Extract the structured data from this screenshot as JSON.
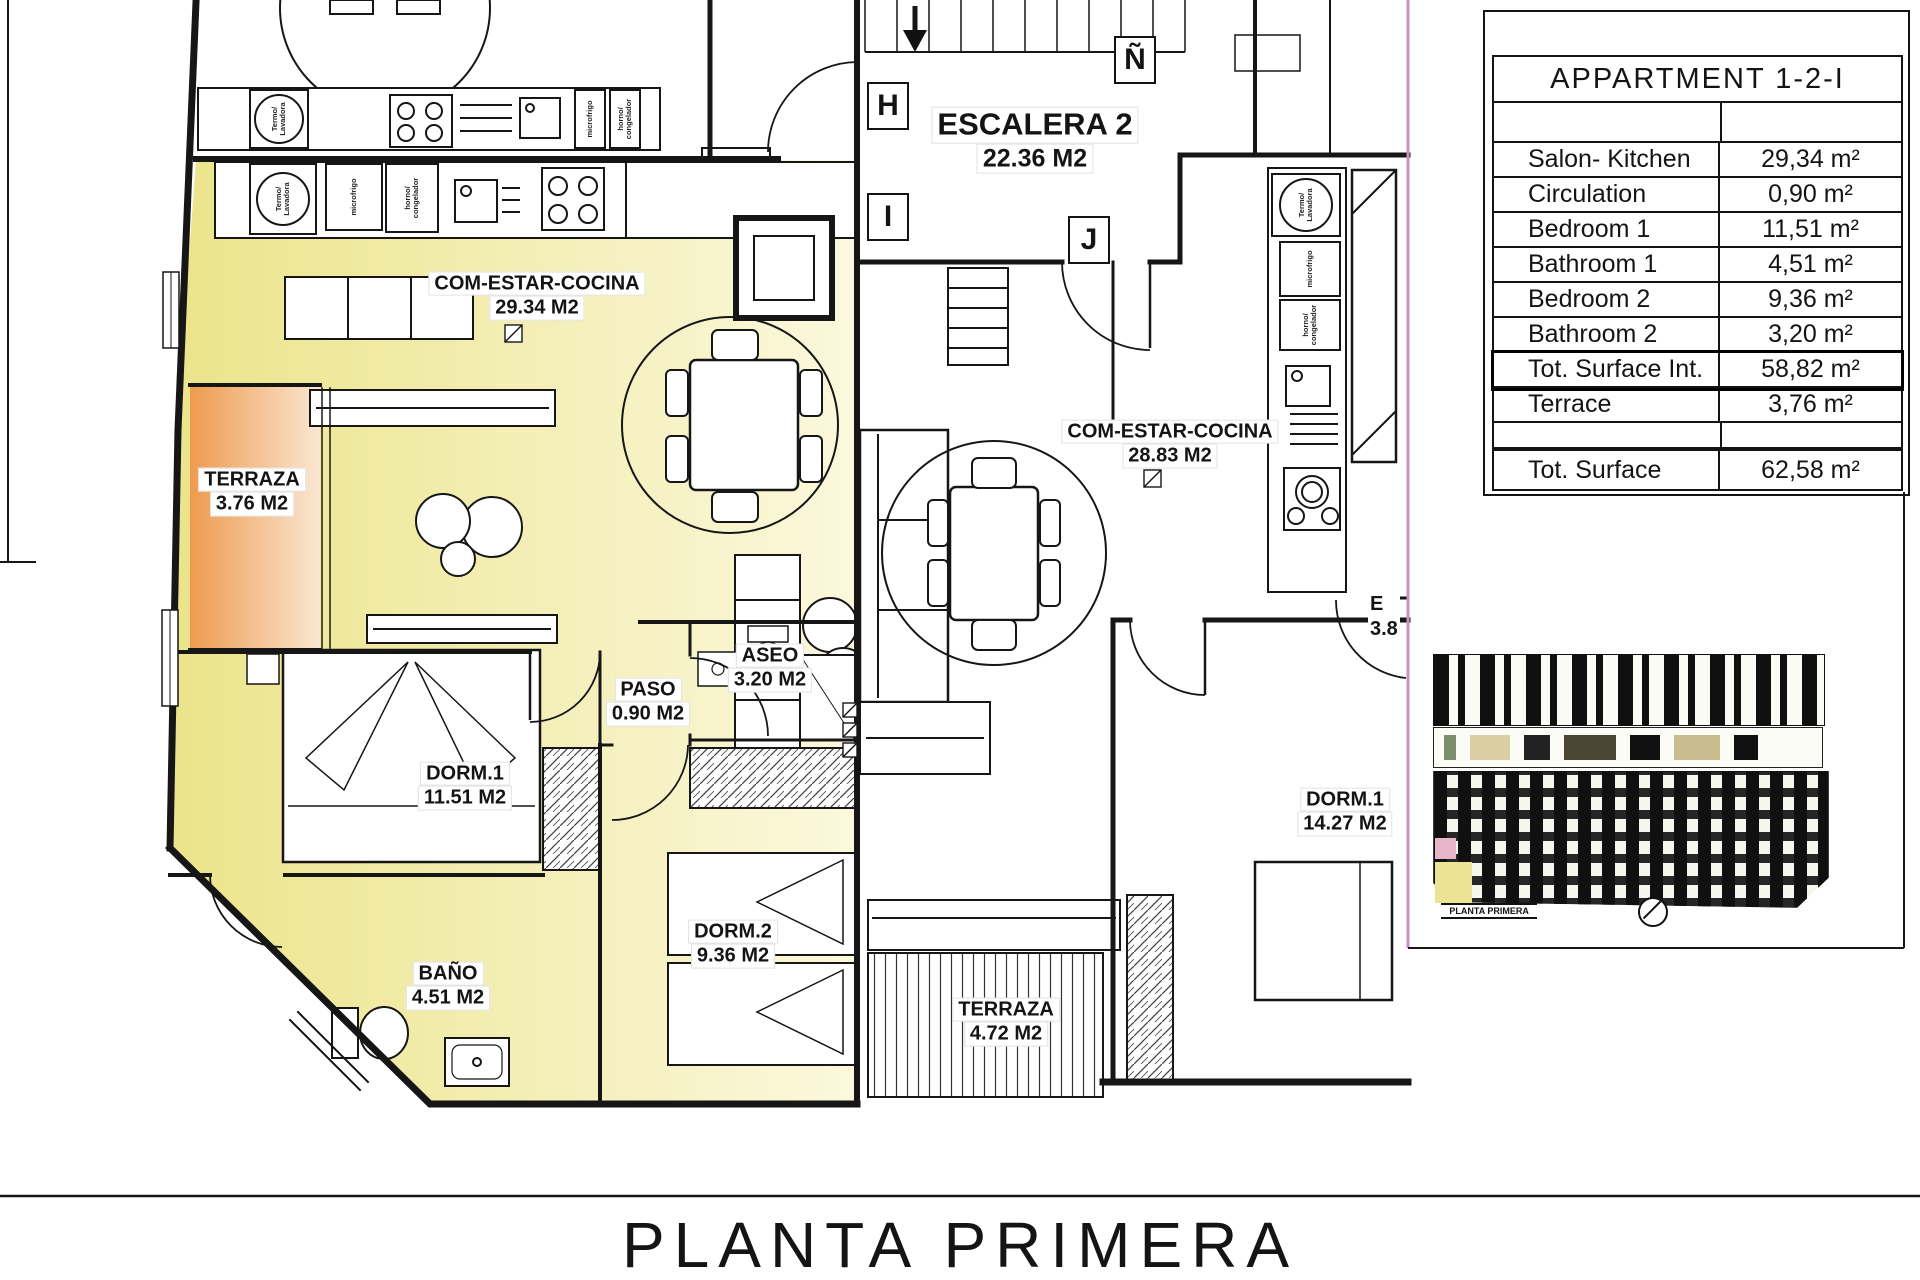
{
  "sheet": {
    "title": "PLANTA PRIMERA"
  },
  "summary_table": {
    "header": "APPARTMENT 1-2-I",
    "rows": [
      {
        "label": "Salon- Kitchen",
        "value": "29,34 m²"
      },
      {
        "label": "Circulation",
        "value": "0,90 m²"
      },
      {
        "label": "Bedroom 1",
        "value": "11,51 m²"
      },
      {
        "label": "Bathroom 1",
        "value": "4,51 m²"
      },
      {
        "label": "Bedroom 2",
        "value": "9,36 m²"
      },
      {
        "label": "Bathroom 2",
        "value": "3,20 m²"
      },
      {
        "label": "Tot. Surface Int.",
        "value": "58,82 m²"
      },
      {
        "label": "Terrace",
        "value": "3,76 m²"
      }
    ],
    "total": {
      "label": "Tot. Surface",
      "value": "62,58 m²"
    }
  },
  "rooms": [
    {
      "name": "COM-ESTAR-COCINA",
      "area": "29.34 M2"
    },
    {
      "name": "TERRAZA",
      "area": "3.76 M2"
    },
    {
      "name": "DORM.1",
      "area": "11.51 M2"
    },
    {
      "name": "PASO",
      "area": "0.90 M2"
    },
    {
      "name": "ASEO",
      "area": "3.20 M2"
    },
    {
      "name": "DORM.2",
      "area": "9.36 M2"
    },
    {
      "name": "BAÑO",
      "area": "4.51 M2"
    },
    {
      "name": "ESCALERA 2",
      "area": "22.36 M2"
    },
    {
      "name": "COM-ESTAR-COCINA",
      "area": "28.83 M2"
    },
    {
      "name": "DORM.1",
      "area": "14.27 M2"
    },
    {
      "name": "TERRAZA",
      "area": "4.72 M2"
    }
  ],
  "markers": [
    {
      "letter": "H"
    },
    {
      "letter": "I"
    },
    {
      "letter": "J"
    },
    {
      "letter": "Ñ"
    }
  ],
  "partial_label": {
    "top": "E",
    "bottom": "3.8"
  },
  "appliances": {
    "boiler": "Termo/\nLavadora",
    "fridge": "microfrigo",
    "oven": "horno/\ncongelador"
  },
  "thumbnail": {
    "caption": "PLANTA PRIMERA"
  },
  "colors": {
    "highlight": "#ede79b",
    "terrace": "#ee9c50",
    "boundary": "#c98fc9"
  }
}
